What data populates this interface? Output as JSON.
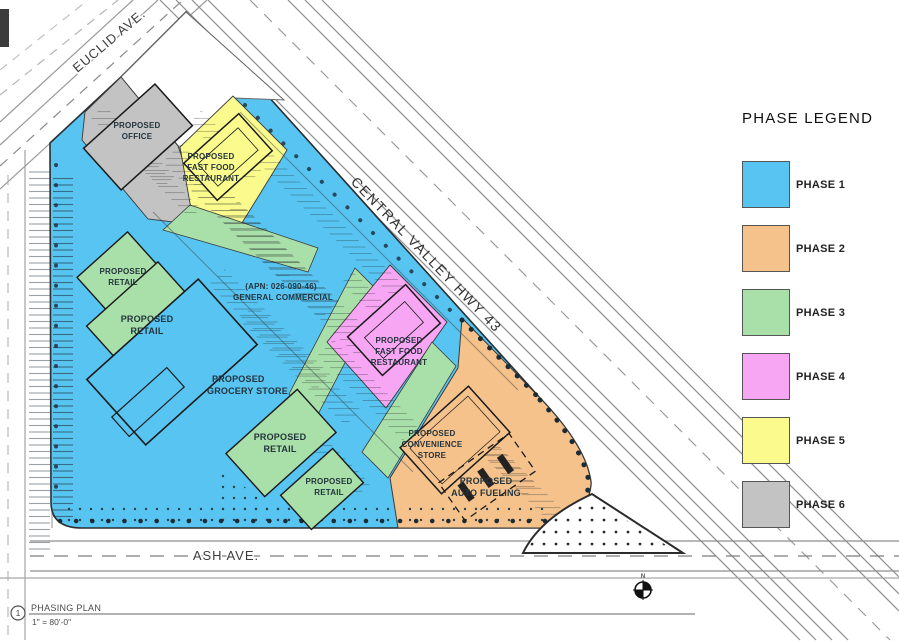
{
  "legend": {
    "title": "PHASE LEGEND",
    "items": [
      {
        "label": "PHASE 1",
        "color": "#57c4f1"
      },
      {
        "label": "PHASE 2",
        "color": "#f5c28c"
      },
      {
        "label": "PHASE 3",
        "color": "#a9dfa8"
      },
      {
        "label": "PHASE 4",
        "color": "#f7a6f3"
      },
      {
        "label": "PHASE 5",
        "color": "#fbfb8d"
      },
      {
        "label": "PHASE 6",
        "color": "#c3c3c3"
      }
    ]
  },
  "plan": {
    "roads": {
      "euclid": "EUCLID AVE.",
      "highway": "CENTRAL VALLEY HWY 43",
      "ash": "ASH AVE."
    },
    "labels": {
      "office": [
        "PROPOSED",
        "OFFICE"
      ],
      "fast_food_north": [
        "PROPOSED",
        "FAST FOOD",
        "RESTAURANT"
      ],
      "retail_nw_small": [
        "PROPOSED",
        "RETAIL"
      ],
      "retail_nw_large": [
        "PROPOSED",
        "RETAIL"
      ],
      "grocery": [
        "PROPOSED",
        "GROCERY STORE"
      ],
      "retail_south_large": [
        "PROPOSED",
        "RETAIL"
      ],
      "retail_south_small": [
        "PROPOSED",
        "RETAIL"
      ],
      "fast_food_east": [
        "PROPOSED",
        "FAST FOOD",
        "RESTAURANT"
      ],
      "convenience": [
        "PROPOSED",
        "CONVENIENCE",
        "STORE"
      ],
      "auto_fueling": [
        "PROPOSED",
        "AUTO FUELING"
      ],
      "zoning_note": [
        "(APN: 026-090-46)",
        "GENERAL COMMERCIAL"
      ]
    },
    "north_label": "N",
    "titleblock": {
      "number": "1",
      "title": "PHASING PLAN",
      "scale": "1\" = 80'-0\""
    }
  }
}
